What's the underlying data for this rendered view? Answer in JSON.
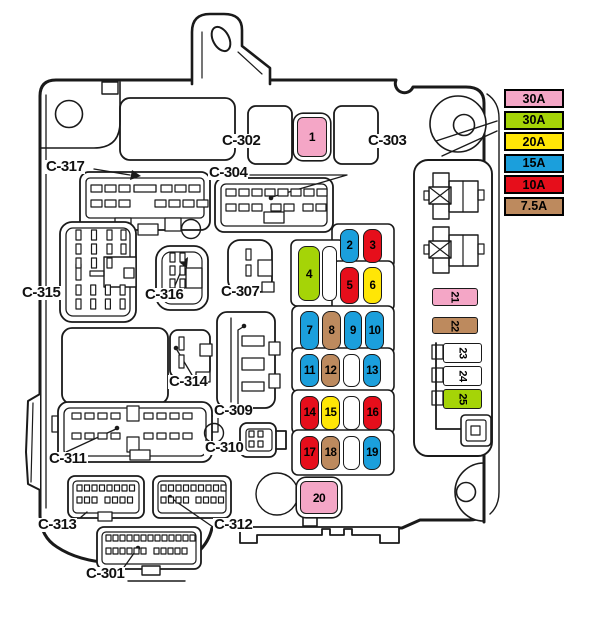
{
  "title": "engine-compartment-fuse-relay-box-diagram",
  "colors": {
    "pink": "#F4A6C6",
    "green": "#A5D407",
    "yellow": "#FFE606",
    "blue": "#1B9FDC",
    "red": "#E60E1B",
    "brown": "#BD8A5E",
    "white": "#FFFFFF",
    "line": "#1A1A1A"
  },
  "legend": {
    "items": [
      {
        "label": "30A",
        "color": "pink"
      },
      {
        "label": "30A",
        "color": "green"
      },
      {
        "label": "20A",
        "color": "yellow"
      },
      {
        "label": "15A",
        "color": "blue"
      },
      {
        "label": "10A",
        "color": "red"
      },
      {
        "label": "7.5A",
        "color": "brown"
      }
    ]
  },
  "labels": {
    "c301": "C-301",
    "c302": "C-302",
    "c303": "C-303",
    "c304": "C-304",
    "c307": "C-307",
    "c309": "C-309",
    "c310": "C-310",
    "c311": "C-311",
    "c312": "C-312",
    "c313": "C-313",
    "c314": "C-314",
    "c315": "C-315",
    "c316": "C-316",
    "c317": "C-317"
  },
  "fuses": [
    {
      "num": "1",
      "color": "pink",
      "amps": "30A"
    },
    {
      "num": "2",
      "color": "blue",
      "amps": "15A"
    },
    {
      "num": "3",
      "color": "red",
      "amps": "10A"
    },
    {
      "num": "4",
      "color": "green",
      "amps": "30A"
    },
    {
      "num": "5",
      "color": "red",
      "amps": "10A"
    },
    {
      "num": "6",
      "color": "yellow",
      "amps": "20A"
    },
    {
      "num": "7",
      "color": "blue",
      "amps": "15A"
    },
    {
      "num": "8",
      "color": "brown",
      "amps": "7.5A"
    },
    {
      "num": "9",
      "color": "blue",
      "amps": "15A"
    },
    {
      "num": "10",
      "color": "blue",
      "amps": "15A"
    },
    {
      "num": "11",
      "color": "blue",
      "amps": "15A"
    },
    {
      "num": "12",
      "color": "brown",
      "amps": "7.5A"
    },
    {
      "num": "13",
      "color": "blue",
      "amps": "15A"
    },
    {
      "num": "14",
      "color": "red",
      "amps": "10A"
    },
    {
      "num": "15",
      "color": "yellow",
      "amps": "20A"
    },
    {
      "num": "16",
      "color": "red",
      "amps": "10A"
    },
    {
      "num": "17",
      "color": "red",
      "amps": "10A"
    },
    {
      "num": "18",
      "color": "brown",
      "amps": "7.5A"
    },
    {
      "num": "19",
      "color": "blue",
      "amps": "15A"
    },
    {
      "num": "20",
      "color": "pink",
      "amps": "30A"
    },
    {
      "num": "21",
      "color": "pink",
      "amps": "30A"
    },
    {
      "num": "22",
      "color": "brown",
      "amps": "7.5A"
    },
    {
      "num": "23",
      "color": "white",
      "amps": ""
    },
    {
      "num": "24",
      "color": "white",
      "amps": ""
    },
    {
      "num": "25",
      "color": "green",
      "amps": "30A"
    }
  ]
}
